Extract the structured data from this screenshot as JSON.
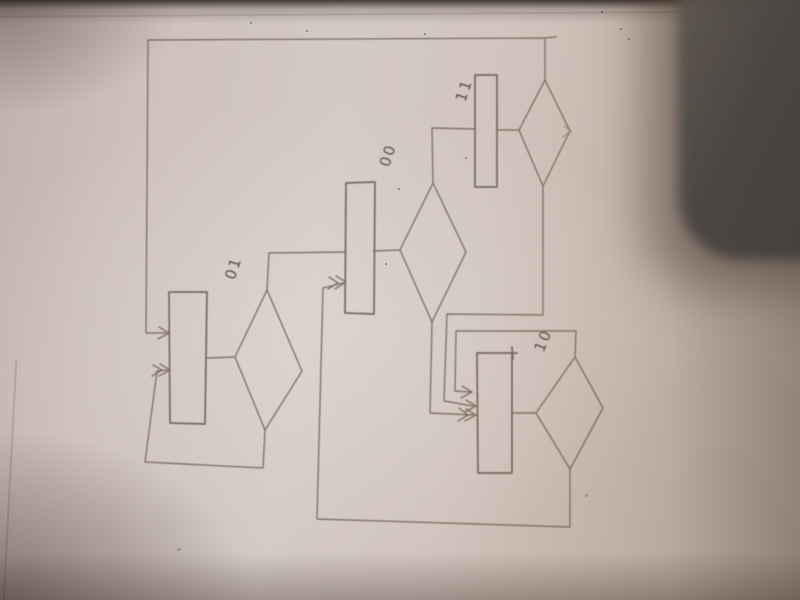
{
  "scene": {
    "type": "photograph of a pencil-drawn flowchart on paper",
    "paper_color": "#d2c6bf",
    "pencil_color": "#7a6c60",
    "dark_object_color": "#4a4440"
  },
  "diagram": {
    "type": "state flowchart, four states each with a process rectangle and a decision diamond",
    "states": [
      {
        "id": "01",
        "label": "01",
        "shapes": [
          "process-rectangle",
          "decision-diamond"
        ]
      },
      {
        "id": "00",
        "label": "00",
        "shapes": [
          "process-rectangle",
          "decision-diamond"
        ]
      },
      {
        "id": "11",
        "label": "11",
        "shapes": [
          "process-rectangle",
          "decision-diamond"
        ]
      },
      {
        "id": "10",
        "label": "10",
        "shapes": [
          "process-rectangle",
          "decision-diamond"
        ]
      }
    ],
    "transitions": [
      {
        "from": "diamond-11-top",
        "to": "rect-01",
        "route": "up, long loop across top and down left side"
      },
      {
        "from": "diamond-01-bottom",
        "to": "rect-01",
        "route": "lower-left self loop"
      },
      {
        "from": "diamond-01-top",
        "to": "rect-00",
        "route": "up then right"
      },
      {
        "from": "diamond-10-bottom",
        "to": "rect-00",
        "route": "long bottom loop left then up"
      },
      {
        "from": "diamond-00-top",
        "to": "rect-11",
        "route": "up then right"
      },
      {
        "from": "diamond-00-bottom",
        "to": "rect-10",
        "route": "down then right"
      },
      {
        "from": "diamond-11-bottom",
        "to": "rect-10",
        "route": "down, left, down, right"
      },
      {
        "from": "diamond-10-top",
        "to": "rect-10",
        "route": "upper self loop"
      }
    ]
  }
}
